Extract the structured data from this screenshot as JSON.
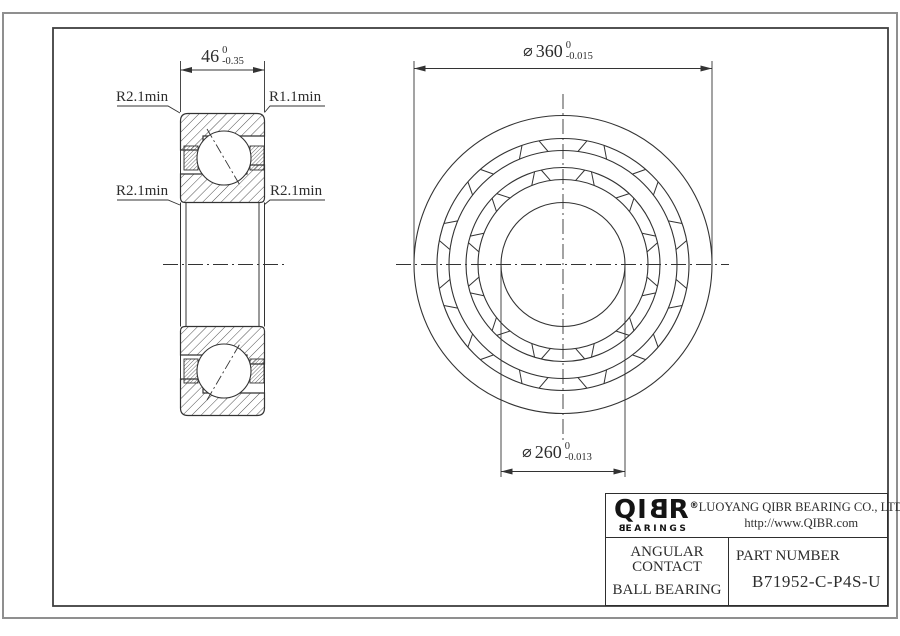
{
  "views": {
    "section": {
      "width_dim": {
        "value": "46",
        "tol_upper": "0",
        "tol_lower": "-0.35"
      },
      "label_top_left": "R2.1min",
      "label_top_right": "R1.1min",
      "label_mid_left": "R2.1min",
      "label_mid_right": "R2.1min"
    },
    "front": {
      "outer_dia": {
        "symbol": "⌀",
        "value": "360",
        "tol_upper": "0",
        "tol_lower": "-0.015"
      },
      "bore_dia": {
        "symbol": "⌀",
        "value": "260",
        "tol_upper": "0",
        "tol_lower": "-0.013"
      }
    }
  },
  "title_block": {
    "logo": {
      "l1": "Q",
      "l2": "I",
      "l3": "B",
      "l4": "R",
      "reg": "®",
      "wordmark_first": "B",
      "wordmark_rest": "EARINGS"
    },
    "company": "LUOYANG QIBR BEARING CO., LTD",
    "website": "http://www.QIBR.com",
    "product": {
      "line1": "ANGULAR CONTACT",
      "line2": "BALL BEARING"
    },
    "part_label": "PART NUMBER",
    "part_number": "B71952-C-P4S-U"
  },
  "colors": {
    "line": "#333333",
    "frame_outer": "#8f8f8f",
    "background": "#ffffff"
  }
}
